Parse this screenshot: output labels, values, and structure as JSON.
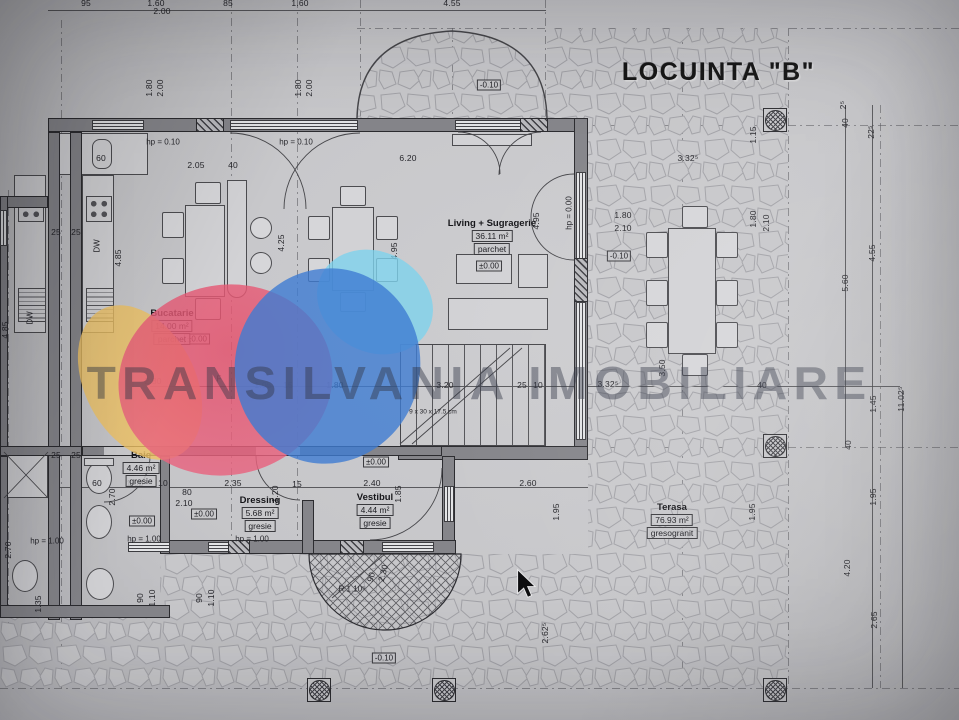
{
  "title": "LOCUINTA \"B\"",
  "watermark": {
    "text": "TRANSILVANIA IMOBILIARE",
    "logo_colors": {
      "yellow": "#efc263",
      "pink": "#e85f7a",
      "blue": "#3f7cd2",
      "cyan": "#7ed2ec"
    }
  },
  "rooms": [
    {
      "name": "Bucatarie",
      "area": "14.00 m²",
      "finish": "parchet",
      "x": 172,
      "y": 308
    },
    {
      "name": "Living + Sugragerie",
      "area": "36.11 m²",
      "finish": "parchet",
      "x": 492,
      "y": 218
    },
    {
      "name": "Baie",
      "area": "4.46 m²",
      "finish": "gresie",
      "x": 141,
      "y": 450
    },
    {
      "name": "Dressing",
      "area": "5.68 m²",
      "finish": "gresie",
      "x": 260,
      "y": 495
    },
    {
      "name": "Vestibul",
      "area": "4.44 m²",
      "finish": "gresie",
      "x": 375,
      "y": 492
    },
    {
      "name": "Terasa",
      "area": "76.93 m²",
      "finish": "gresogranit",
      "x": 672,
      "y": 502
    }
  ],
  "levels": [
    {
      "text": "±0.00",
      "x": 197,
      "y": 339
    },
    {
      "text": "±0.00",
      "x": 489,
      "y": 266
    },
    {
      "text": "±0.00",
      "x": 142,
      "y": 521
    },
    {
      "text": "±0.00",
      "x": 204,
      "y": 514
    },
    {
      "text": "±0.00",
      "x": 376,
      "y": 462
    },
    {
      "text": "-0.10",
      "x": 489,
      "y": 85
    },
    {
      "text": "-0.10",
      "x": 619,
      "y": 256
    },
    {
      "text": "-0.10",
      "x": 384,
      "y": 658
    }
  ],
  "hp_labels": [
    {
      "text": "hp = 0.10",
      "x": 163,
      "y": 142
    },
    {
      "text": "hp = 0.10",
      "x": 296,
      "y": 142
    },
    {
      "text": "hp = 0.00",
      "x": 569,
      "y": 213,
      "r": -90
    },
    {
      "text": "hp = 1.00",
      "x": 47,
      "y": 541
    },
    {
      "text": "hp = 1.00",
      "x": 144,
      "y": 539
    },
    {
      "text": "hp = 1.00",
      "x": 252,
      "y": 539
    }
  ],
  "annotations": [
    {
      "t": "9 x 30 x 17.5 cm",
      "x": 433,
      "y": 412,
      "s": 6.5
    },
    {
      "t": "R 1.10⁵",
      "x": 352,
      "y": 589
    },
    {
      "t": "DW",
      "x": 97,
      "y": 246,
      "r": -90
    },
    {
      "t": "DW",
      "x": 30,
      "y": 318,
      "r": -90
    },
    {
      "t": "F",
      "x": 219,
      "y": 379
    }
  ],
  "dimensions": [
    {
      "t": "95",
      "x": 86,
      "y": 3
    },
    {
      "t": "1.60",
      "x": 156,
      "y": 3
    },
    {
      "t": "2.00",
      "x": 162,
      "y": 11
    },
    {
      "t": "85",
      "x": 228,
      "y": 3
    },
    {
      "t": "1.60",
      "x": 300,
      "y": 3
    },
    {
      "t": "4.55",
      "x": 452,
      "y": 3
    },
    {
      "t": "60",
      "x": 101,
      "y": 158
    },
    {
      "t": "2.05",
      "x": 196,
      "y": 165
    },
    {
      "t": "40",
      "x": 233,
      "y": 165
    },
    {
      "t": "6.20",
      "x": 408,
      "y": 158
    },
    {
      "t": "3.32⁵",
      "x": 688,
      "y": 158
    },
    {
      "t": "1.80",
      "x": 149,
      "y": 88,
      "r": -90
    },
    {
      "t": "2.00",
      "x": 160,
      "y": 88,
      "r": -90
    },
    {
      "t": "1.80",
      "x": 298,
      "y": 88,
      "r": -90
    },
    {
      "t": "2.00",
      "x": 309,
      "y": 88,
      "r": -90
    },
    {
      "t": "1.15",
      "x": 753,
      "y": 135,
      "r": -90
    },
    {
      "t": "2⁵",
      "x": 843,
      "y": 105,
      "r": -90
    },
    {
      "t": "40",
      "x": 845,
      "y": 123,
      "r": -90
    },
    {
      "t": "22⁵",
      "x": 871,
      "y": 132,
      "r": -90
    },
    {
      "t": "4.55",
      "x": 872,
      "y": 253,
      "r": -90
    },
    {
      "t": "5.60",
      "x": 845,
      "y": 283,
      "r": -90
    },
    {
      "t": "1.80",
      "x": 623,
      "y": 215
    },
    {
      "t": "2.10",
      "x": 623,
      "y": 228
    },
    {
      "t": "1.80",
      "x": 753,
      "y": 219,
      "r": -90
    },
    {
      "t": "2.10",
      "x": 766,
      "y": 223,
      "r": -90
    },
    {
      "t": "4.95",
      "x": 536,
      "y": 221,
      "r": -90
    },
    {
      "t": "4.95",
      "x": 394,
      "y": 251,
      "r": -90
    },
    {
      "t": "4.25",
      "x": 281,
      "y": 243,
      "r": -90
    },
    {
      "t": "4.85",
      "x": 118,
      "y": 258,
      "r": -90
    },
    {
      "t": "4.85",
      "x": 5,
      "y": 330,
      "r": -90
    },
    {
      "t": "2.80",
      "x": 153,
      "y": 381
    },
    {
      "t": "1.05",
      "x": 263,
      "y": 385
    },
    {
      "t": "15",
      "x": 288,
      "y": 385
    },
    {
      "t": "1.80",
      "x": 335,
      "y": 385
    },
    {
      "t": "3.20",
      "x": 445,
      "y": 385
    },
    {
      "t": "25",
      "x": 522,
      "y": 385
    },
    {
      "t": "10",
      "x": 538,
      "y": 385
    },
    {
      "t": "3.32⁵",
      "x": 608,
      "y": 384
    },
    {
      "t": "3.50",
      "x": 662,
      "y": 368,
      "r": -90
    },
    {
      "t": "40",
      "x": 762,
      "y": 385
    },
    {
      "t": "1.45",
      "x": 873,
      "y": 404,
      "r": -90
    },
    {
      "t": "11.02⁵",
      "x": 901,
      "y": 399,
      "r": -90
    },
    {
      "t": "40",
      "x": 848,
      "y": 445,
      "r": -90
    },
    {
      "t": "1.95",
      "x": 873,
      "y": 497,
      "r": -90
    },
    {
      "t": "1.95",
      "x": 752,
      "y": 512,
      "r": -90
    },
    {
      "t": "4.20",
      "x": 847,
      "y": 568,
      "r": -90
    },
    {
      "t": "2.65",
      "x": 874,
      "y": 620,
      "r": -90
    },
    {
      "t": "60",
      "x": 97,
      "y": 483
    },
    {
      "t": "1.05",
      "x": 135,
      "y": 483
    },
    {
      "t": "10",
      "x": 163,
      "y": 483
    },
    {
      "t": "80",
      "x": 187,
      "y": 492
    },
    {
      "t": "2.10",
      "x": 184,
      "y": 503
    },
    {
      "t": "2.35",
      "x": 233,
      "y": 483
    },
    {
      "t": "15",
      "x": 297,
      "y": 484
    },
    {
      "t": "2.40",
      "x": 372,
      "y": 483
    },
    {
      "t": "1.20",
      "x": 275,
      "y": 494,
      "r": -90
    },
    {
      "t": "1.85",
      "x": 398,
      "y": 494,
      "r": -90
    },
    {
      "t": "2.60",
      "x": 528,
      "y": 483
    },
    {
      "t": "1.95",
      "x": 556,
      "y": 512,
      "r": -90
    },
    {
      "t": "2.70",
      "x": 112,
      "y": 497,
      "r": -90
    },
    {
      "t": "2.70",
      "x": 8,
      "y": 550,
      "r": -90
    },
    {
      "t": "25",
      "x": 56,
      "y": 232
    },
    {
      "t": "25",
      "x": 76,
      "y": 232
    },
    {
      "t": "25",
      "x": 56,
      "y": 455
    },
    {
      "t": "25",
      "x": 76,
      "y": 455
    },
    {
      "t": "90",
      "x": 140,
      "y": 598,
      "r": -90
    },
    {
      "t": "1.10",
      "x": 152,
      "y": 598,
      "r": -90
    },
    {
      "t": "90",
      "x": 199,
      "y": 598,
      "r": -90
    },
    {
      "t": "1.10",
      "x": 211,
      "y": 598,
      "r": -90
    },
    {
      "t": "1.35",
      "x": 38,
      "y": 604,
      "r": -90
    },
    {
      "t": "2.30",
      "x": 383,
      "y": 573,
      "r": -75
    },
    {
      "t": "90",
      "x": 371,
      "y": 577,
      "r": -75
    },
    {
      "t": "2.62⁵",
      "x": 545,
      "y": 633,
      "r": -90
    }
  ]
}
